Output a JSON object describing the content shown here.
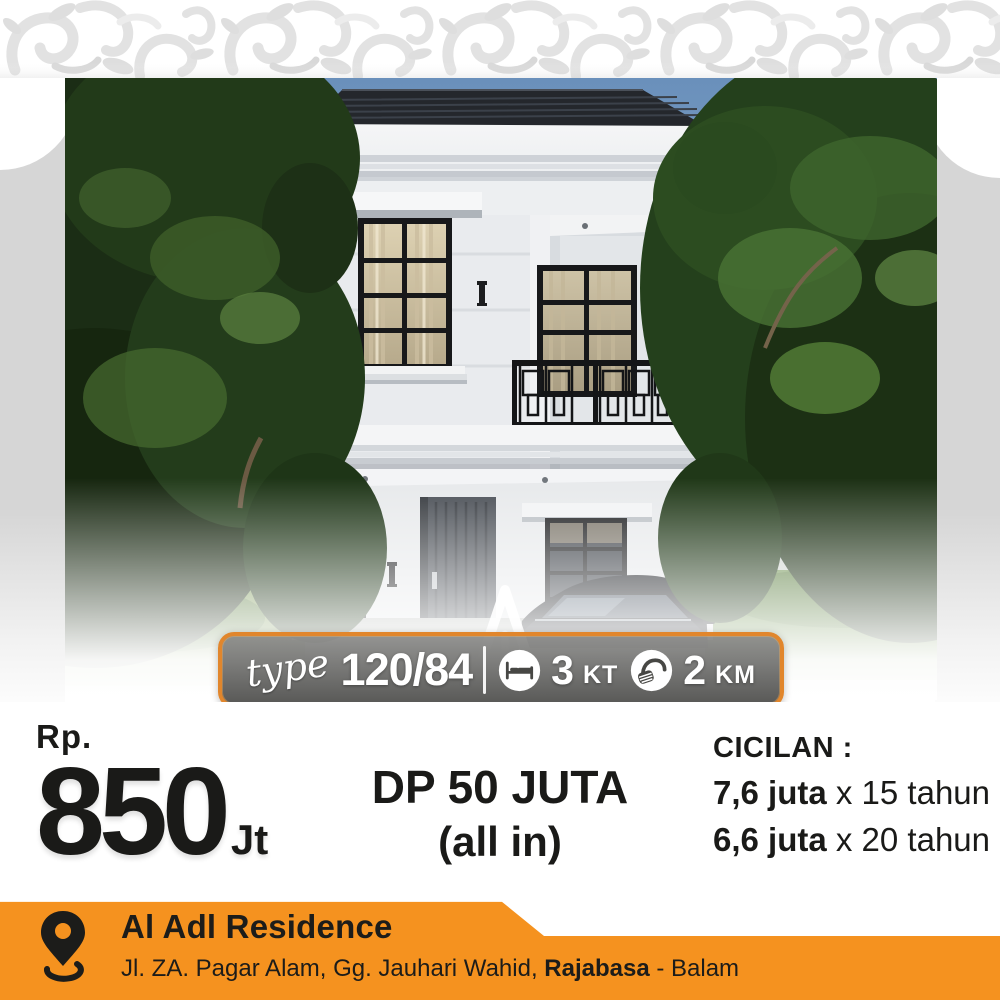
{
  "poster": {
    "spec_banner": {
      "type_label": "type",
      "type_value": "120/84",
      "bedrooms_count": "3",
      "bedrooms_unit": "KT",
      "bathrooms_count": "2",
      "bathrooms_unit": "KM"
    },
    "pricing": {
      "currency_label": "Rp.",
      "price_value": "850",
      "price_unit": "Jt",
      "down_payment_line1": "DP 50 JUTA",
      "down_payment_line2": "(all in)",
      "installment_heading": "CICILAN :",
      "installments": [
        {
          "amount": "7,6 juta",
          "term": " x 15 tahun"
        },
        {
          "amount": "6,6 juta",
          "term": " x 20 tahun"
        }
      ]
    },
    "footer": {
      "project_name": "Al Adl Residence",
      "address_prefix": "Jl. ZA. Pagar Alam, Gg. Jauhari Wahid, ",
      "address_highlight": "Rajabasa",
      "address_suffix": " - Balam"
    },
    "colors": {
      "accent_orange": "#f5921f",
      "banner_border_orange": "#e1862c",
      "text_dark": "#1a1a18",
      "sky_blue": "#6e93bd",
      "roof_dark": "#24272c",
      "foliage_dark": "#1e3317"
    }
  }
}
